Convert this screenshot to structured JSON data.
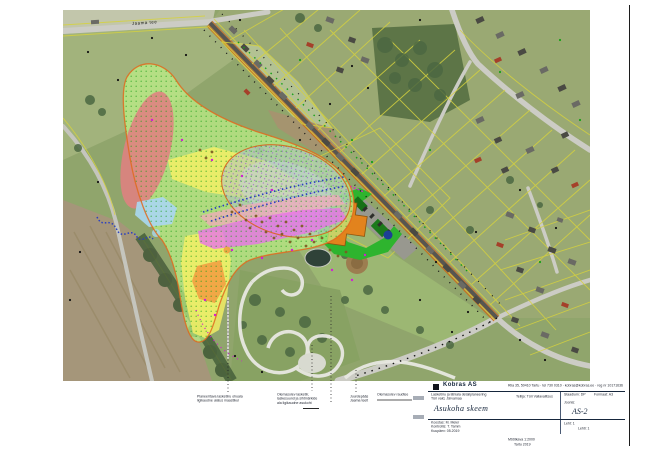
{
  "sheet": {
    "background": "#ffffff",
    "frame_color": "#1c1c1c"
  },
  "map": {
    "road_label": "Jaama tee",
    "legend_colors": {
      "study_area_green": "#bdf287",
      "outline_orange": "#e06a1e",
      "range_zone_red": "#df8181",
      "zone_yellow": "#f7f164",
      "zone_magenta": "#e873e8",
      "zone_pink": "#f2a9bb",
      "zone_light_blue": "#a9d7ef",
      "zone_orange": "#f1a243",
      "impact_area_gray": "#acbfca",
      "facility_green": "#2eb42e",
      "building_orange": "#e2831d",
      "cadastral_yellow": "#d6d23e",
      "railway_brown": "#b97a3c"
    }
  },
  "annotations": {
    "ann1": {
      "line1": "Planeeritava lasketiiru ohuala",
      "line2": "ligikaudne ulatus maastikul"
    },
    "ann2": {
      "line1": "Olemasolev lasketiir,",
      "line2": "laskesuund ja sihtmärkide",
      "line3": "ala ligikaudne asukoht"
    },
    "ann3": {
      "line1": "Juurdepääs",
      "line2": "Jaama teelt"
    },
    "ann4": {
      "line1": "Olemasolev raudtee"
    }
  },
  "title_block": {
    "company": "Kobras AS",
    "company_info": "Riia 35, 50410 Tartu · tel 730 0310 · kobras@kobras.ee · reg nr 10171636",
    "project_line1": "Lasketiiru ja lähiala detailplaneering",
    "project_line2": "Türi vald, Järvamaa",
    "client_line": "Tellija: Türi Vallavalitsus",
    "stage_line": "Staadium: DP",
    "format_line": "Formaat: A3",
    "drawing_label": "Joonis:",
    "drawing_title": "Asukoha skeem",
    "drawing_no": "AS-2",
    "made_by": "Koostas: M. Meier",
    "checked_by": "Kontrollis: T. Tamm",
    "date_line": "Kuupäev: 05.2019",
    "scale_line": "Mõõtkava 1:2000",
    "footer": "Tartu 2019",
    "sheet_line": "Leht: 1",
    "sheets_line": "Lehti: 1"
  }
}
